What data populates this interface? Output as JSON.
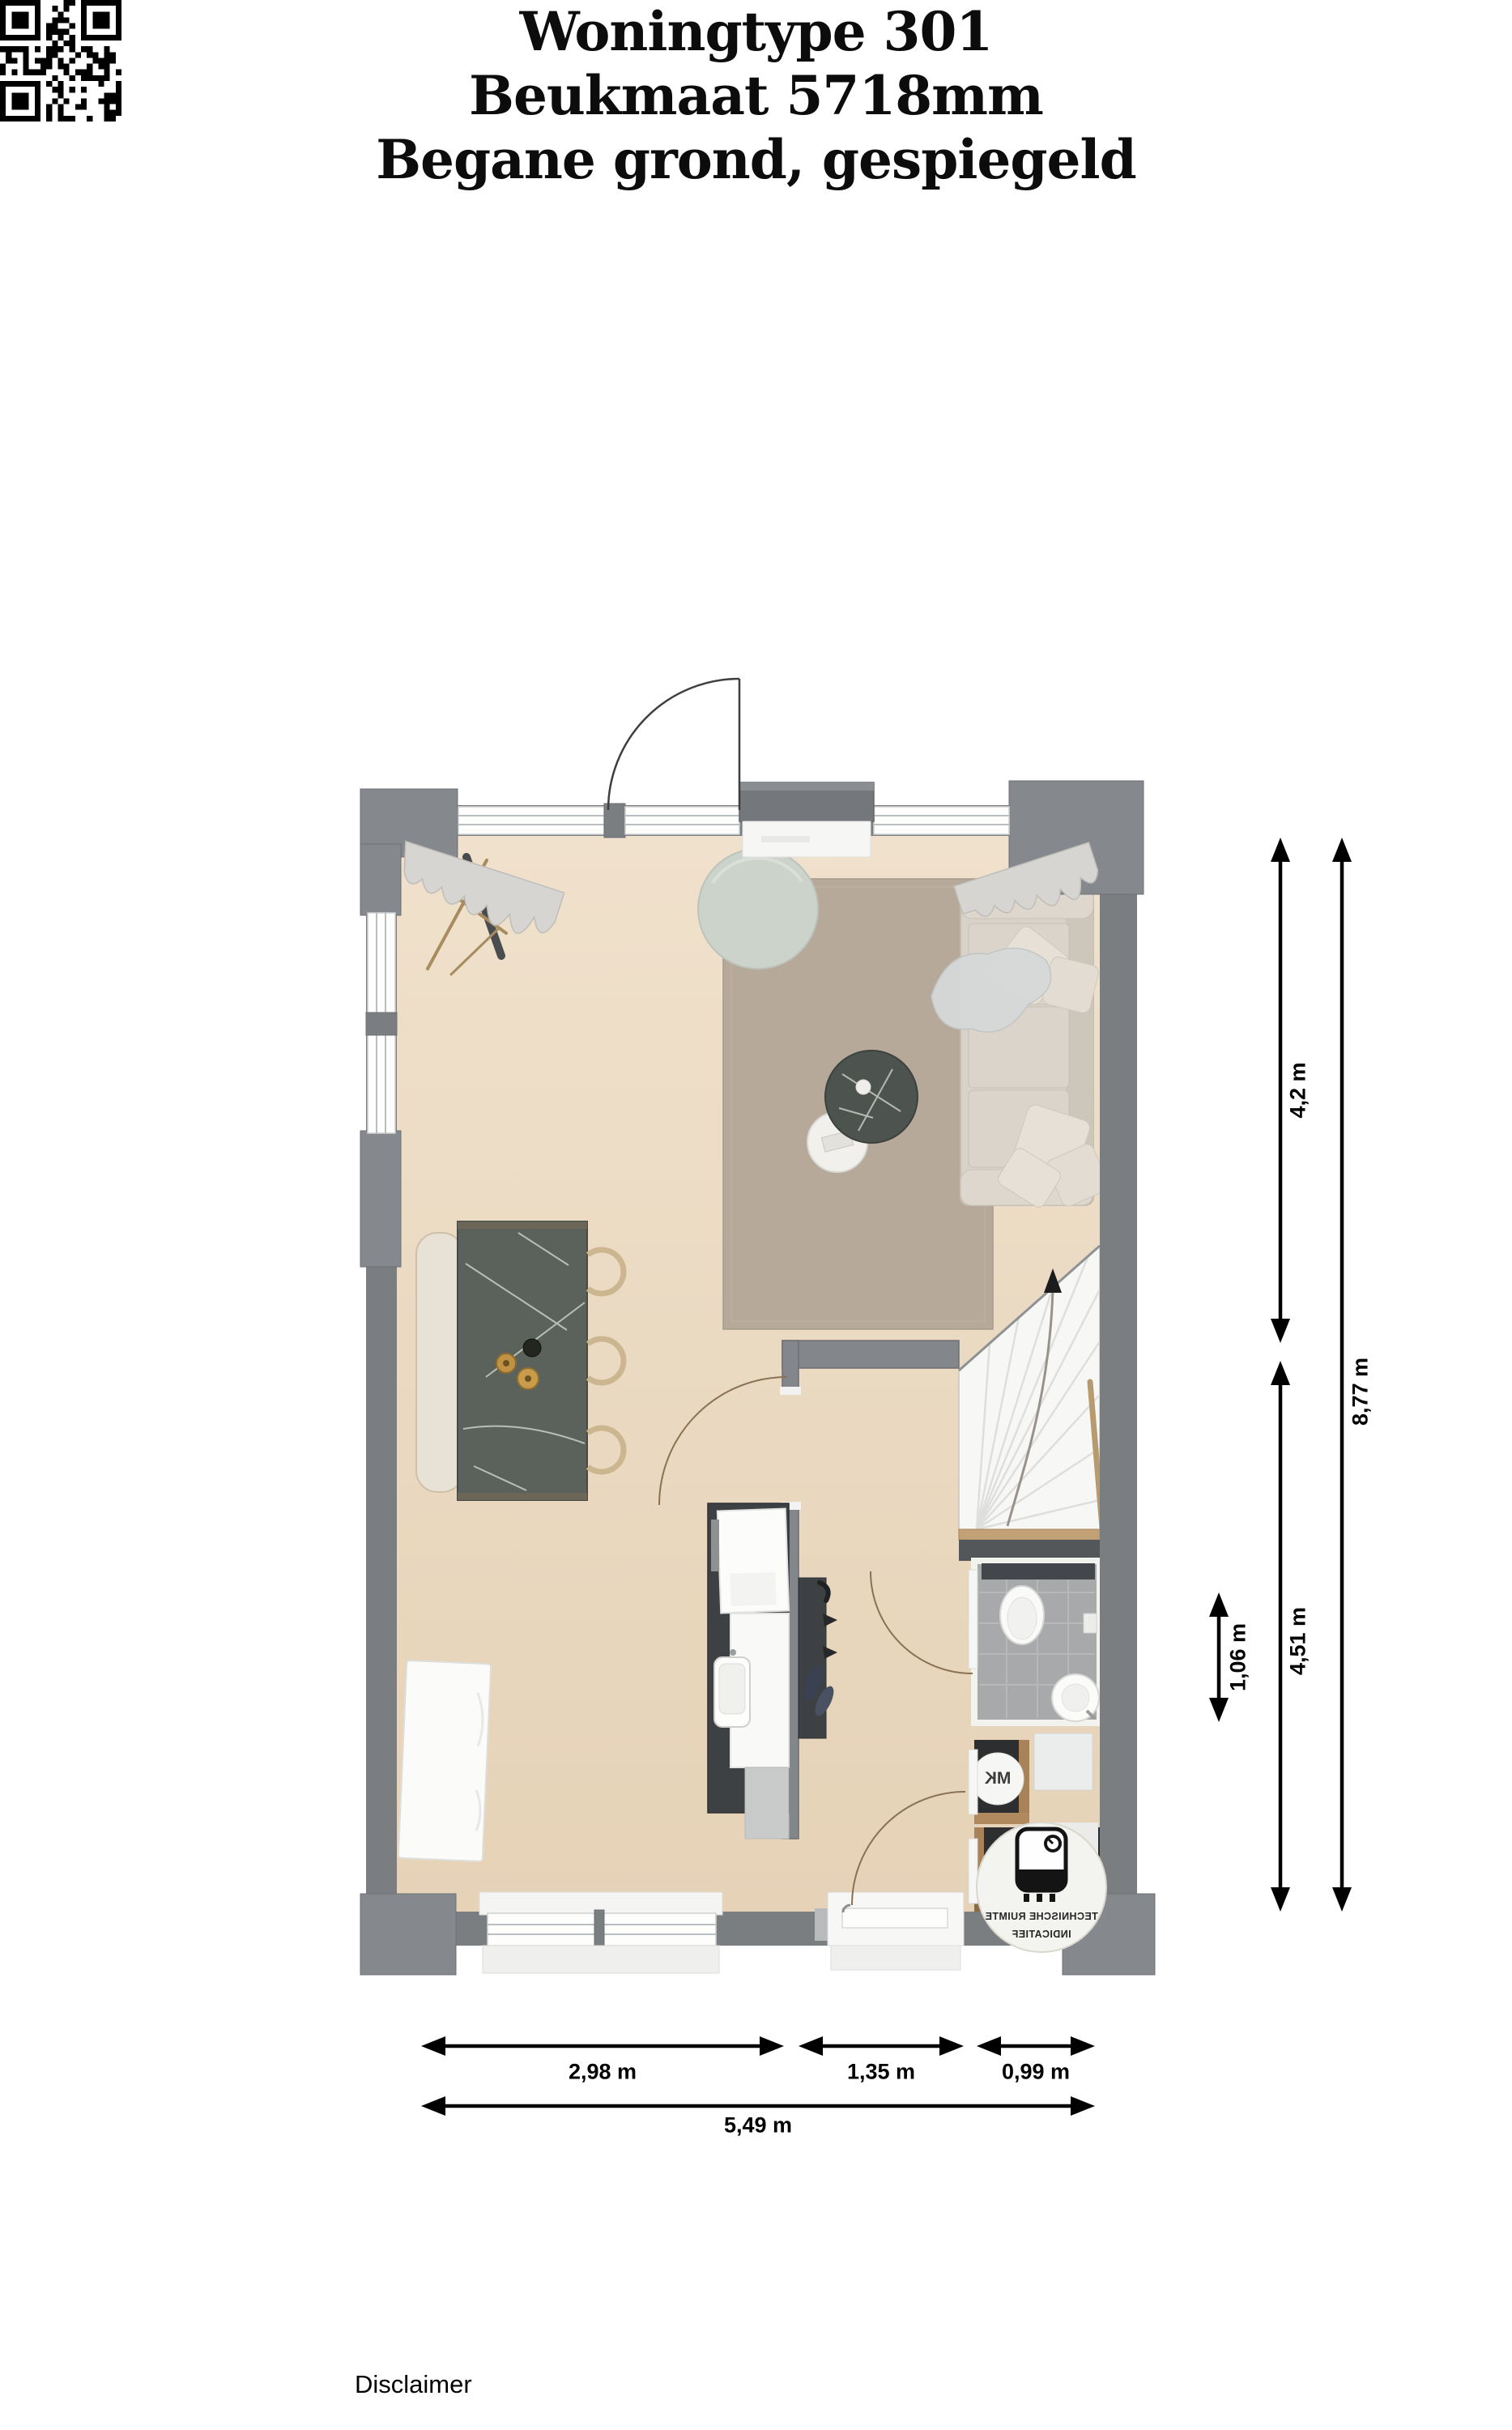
{
  "title": {
    "line1": "Woningtype 301",
    "line2": "Beukmaat 5718mm",
    "line3": "Begane grond, gespiegeld"
  },
  "dimensions": {
    "vertical": [
      {
        "label": "4,2 m"
      },
      {
        "label": "8,77 m"
      },
      {
        "label": "4,51 m"
      },
      {
        "label": "1,06 m"
      }
    ],
    "horizontal": [
      {
        "label": "2,98 m"
      },
      {
        "label": "1,35 m"
      },
      {
        "label": "0,99 m"
      },
      {
        "label": "5,49 m"
      }
    ]
  },
  "plan_labels": {
    "meter_cupboard": "MK",
    "technical_room_line1": "TECHNISCHE RUIMTE",
    "technical_room_line2": "INDICATIEF",
    "labels_mirrored": true
  },
  "footer": {
    "qr_caption": "Disclaimer"
  },
  "colors": {
    "wall": "#7b7e81",
    "wall_dark": "#6d7073",
    "floor": "#ecdbc4",
    "rug": "#b6a999",
    "stairs": "#f7f7f5",
    "bathroom_tile": "#a7a9ab",
    "island_marble": "#5b615b",
    "kitchen_counter": "#3d4144",
    "sofa": "#d8d2c8",
    "pouf": "#ccd3cb",
    "wood_trim": "#b08a5e",
    "dimension_lines": "#000000"
  }
}
